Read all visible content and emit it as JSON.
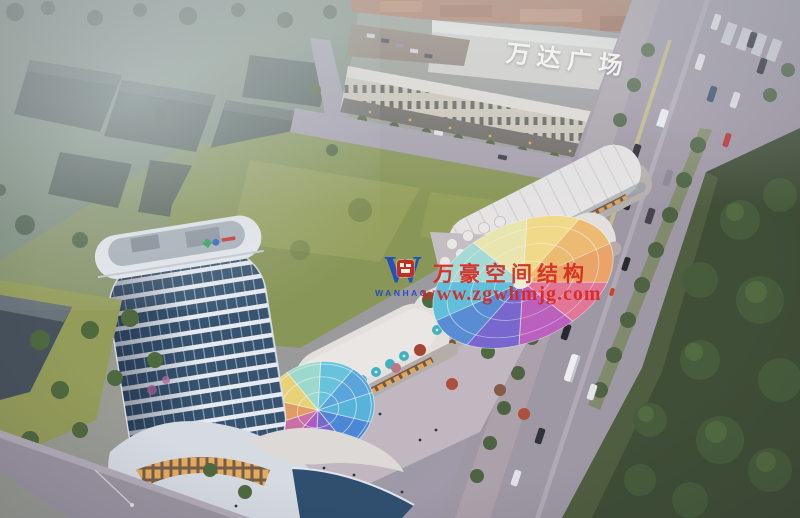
{
  "mall": {
    "sign": "万达广场"
  },
  "watermark": {
    "logo_letter": "W",
    "logo_name": "WANHAO",
    "company": "万豪空间结构",
    "url": "www.zgwhmjg.com"
  },
  "colors": {
    "watermark_red": "#d8281e",
    "watermark_blue": "#1a46c8",
    "field_green": "#8b9955",
    "park_green": "#3e4d33",
    "road_grey": "#a29aa6",
    "tower_glass_blue": "#32506e",
    "canopy_rainbow": [
      "#f2a868",
      "#e87898",
      "#c060c0",
      "#7a68d0",
      "#5890d8",
      "#62c4e0",
      "#a8e0d8",
      "#f0ecb0",
      "#f8e088",
      "#f4c070"
    ],
    "umbrella_teal": "#3fb6c4",
    "roof_terracotta": "#b0795a"
  }
}
